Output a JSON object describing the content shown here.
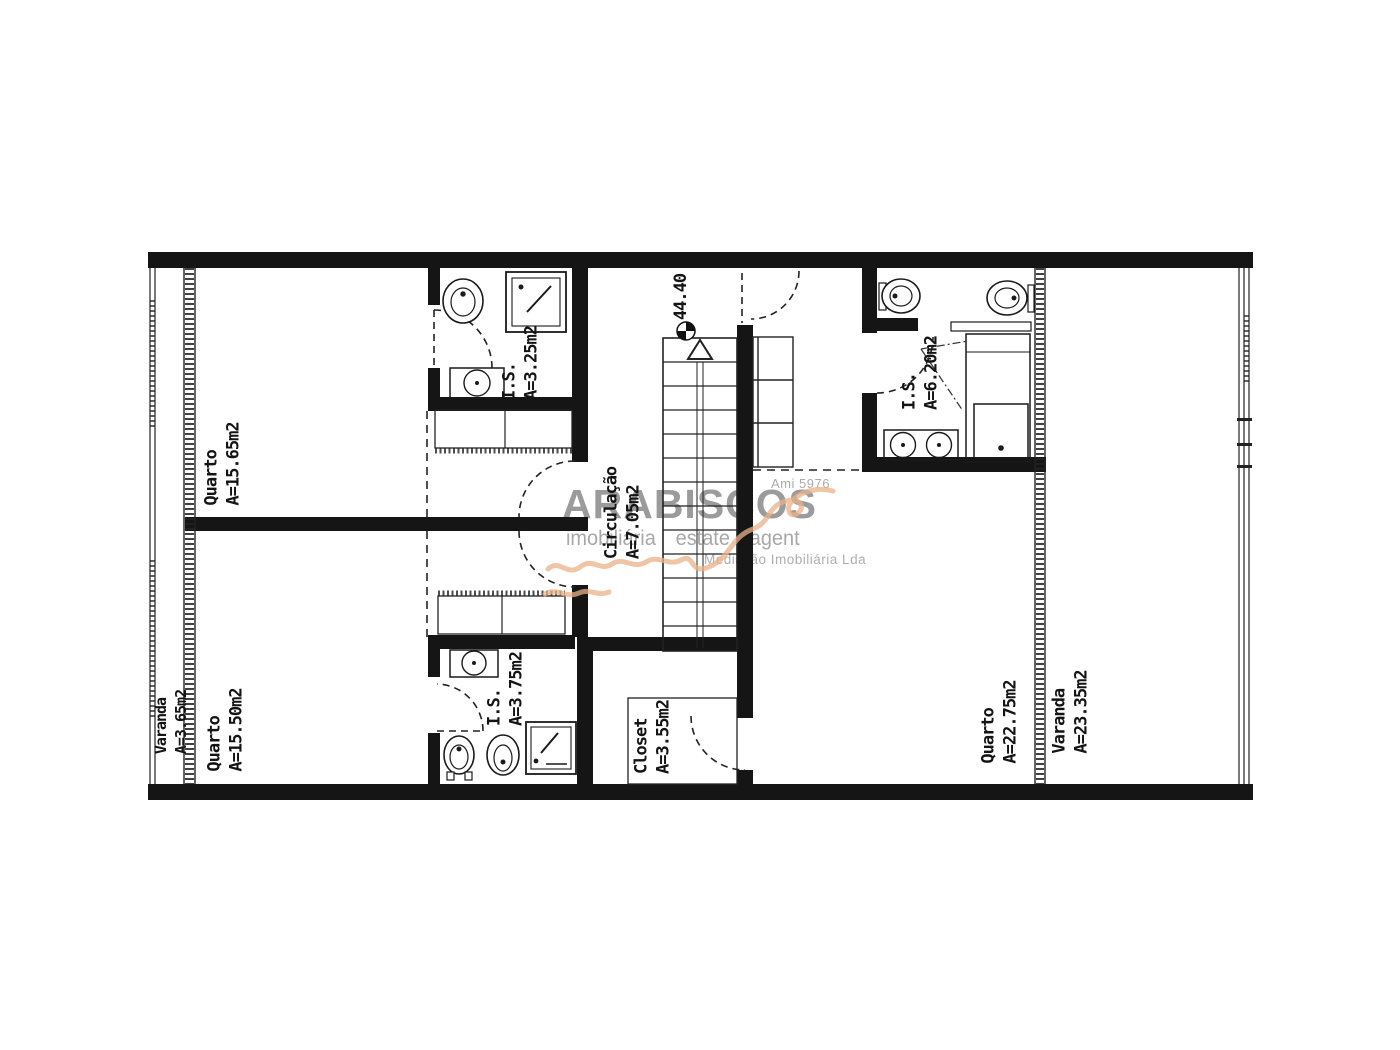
{
  "plan": {
    "rooms": [
      {
        "id": "quarto-1",
        "name": "Quarto",
        "area": "A=15.65m2"
      },
      {
        "id": "quarto-2",
        "name": "Quarto",
        "area": "A=15.50m2"
      },
      {
        "id": "varanda-left",
        "name": "Varanda",
        "area": "A=3.65m2"
      },
      {
        "id": "is-top",
        "name": "I.S.",
        "area": "A=3.25m2"
      },
      {
        "id": "circulacao",
        "name": "Circulação",
        "area": "A=7.05m2"
      },
      {
        "id": "is-right",
        "name": "I.S.",
        "area": "A=6.20m2"
      },
      {
        "id": "is-bottom",
        "name": "I.S.",
        "area": "A=3.75m2"
      },
      {
        "id": "closet",
        "name": "Closet",
        "area": "A=3.55m2"
      },
      {
        "id": "quarto-3",
        "name": "Quarto",
        "area": "A=22.75m2"
      },
      {
        "id": "varanda-right",
        "name": "Varanda",
        "area": "A=23.35m2"
      }
    ],
    "level_mark": "44.40"
  },
  "watermark": {
    "license": "Ami 5976",
    "brand": "ARABISCOS",
    "subtitle": "imobiliária estate agent",
    "company": "Mediação Imobiliária Lda"
  },
  "colors": {
    "wall": "#151515",
    "line": "#222222",
    "watermark_gray": "#9d9d9d",
    "accent_orange": "#eab288",
    "background": "#ffffff"
  }
}
